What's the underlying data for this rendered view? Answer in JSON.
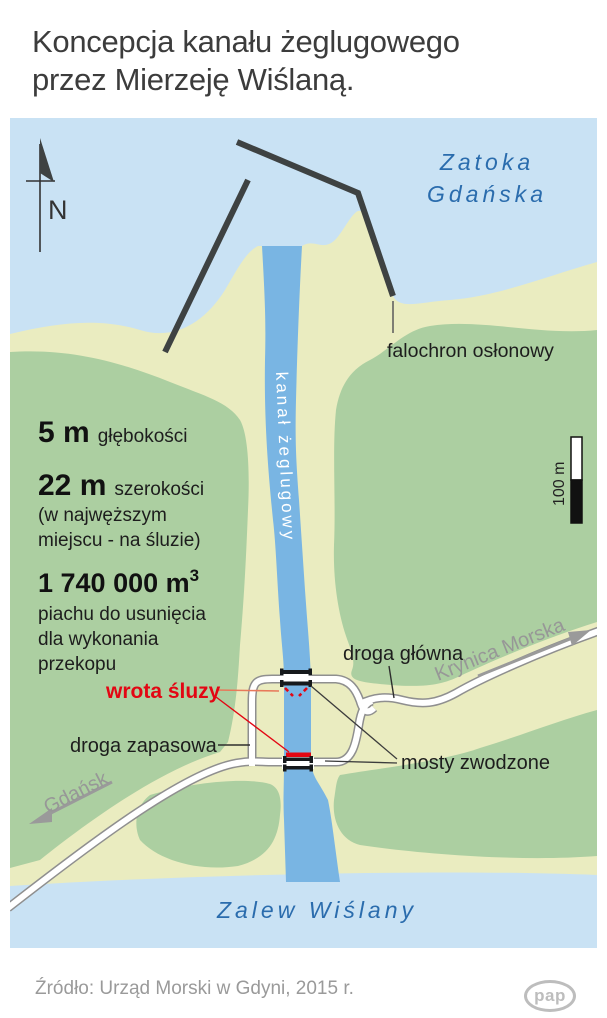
{
  "title": {
    "line1": "Koncepcja kanału żeglugowego",
    "line2": "przez Mierzeję Wiślaną."
  },
  "map": {
    "compass": {
      "label": "N"
    },
    "water_labels": {
      "bay_line1": "Zatoka",
      "bay_line2": "Gdańska",
      "lagoon": "Zalew Wiślany",
      "canal": "kanał żeglugowy"
    },
    "features": {
      "breakwater": "falochron osłonowy",
      "lock_gates": "wrota śluzy",
      "main_road": "droga główna",
      "backup_road": "droga zapasowa",
      "bridges": "mosty zwodzone",
      "direction_west": "Gdańsk",
      "direction_east": "Krynica Morska"
    },
    "stats": {
      "depth_value": "5 m",
      "depth_label": "głębokości",
      "width_value": "22 m",
      "width_label": "szerokości",
      "width_note1": "(w najwęższym",
      "width_note2": "miejscu - na śluzie)",
      "volume_value": "1 740 000 m",
      "volume_sup": "3",
      "volume_label1": "piachu do usunięcia",
      "volume_label2": "dla wykonania",
      "volume_label3": "przekopu"
    },
    "scale": {
      "label": "100 m"
    }
  },
  "footer": {
    "source": "Źródło: Urząd Morski w Gdyni, 2015 r.",
    "logo": "pap"
  },
  "colors": {
    "sea": "#c9e2f4",
    "canal": "#79b5e3",
    "sand": "#eaecc0",
    "green": "#accfa1",
    "road_casing": "#8f8f8f",
    "accent_red": "#e30613",
    "label_blue": "#2a6cad",
    "dark_line": "#3e4242",
    "gray_text": "#979797"
  }
}
